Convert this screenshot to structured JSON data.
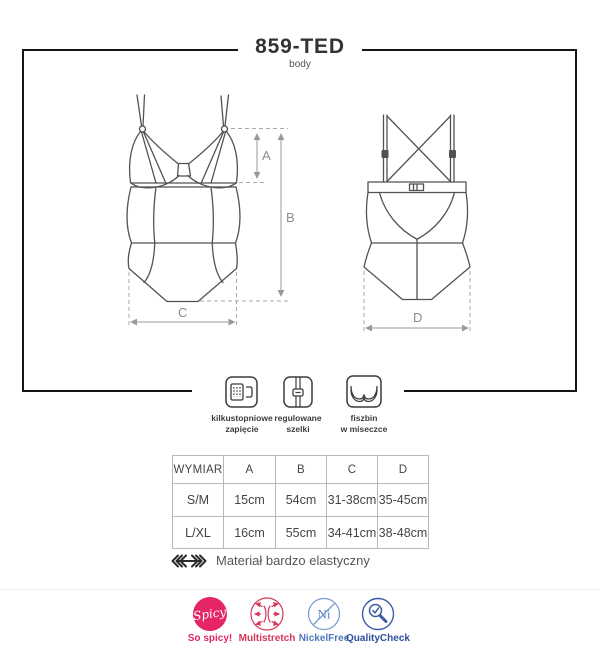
{
  "header": {
    "title": "859-TED",
    "subtitle": "body"
  },
  "diagram": {
    "labels": {
      "a": "A",
      "b": "B",
      "c": "C",
      "d": "D"
    }
  },
  "features": {
    "items": [
      {
        "icon": "hook-clasp-icon",
        "line1": "kilkustopniowe",
        "line2": "zapięcie"
      },
      {
        "icon": "strap-slider-icon",
        "line1": "regulowane",
        "line2": "szelki"
      },
      {
        "icon": "underwire-cup-icon",
        "line1": "fiszbin",
        "line2": "w miseczce"
      }
    ]
  },
  "size_table": {
    "headers": [
      "WYMIAR",
      "A",
      "B",
      "C",
      "D"
    ],
    "rows": [
      [
        "S/M",
        "15cm",
        "54cm",
        "31-38cm",
        "35-45cm"
      ],
      [
        "L/XL",
        "16cm",
        "55cm",
        "34-41cm",
        "38-48cm"
      ]
    ]
  },
  "material_note": {
    "icon": "stretch-arrow-icon",
    "text": "Materiał bardzo elastyczny"
  },
  "badges": {
    "items": [
      {
        "name": "spicy",
        "circle_text": "Spicy",
        "label": "So spicy!",
        "color": "#e62565"
      },
      {
        "name": "multistretch",
        "label": "Multistretch",
        "color": "#d6365a"
      },
      {
        "name": "nickel-free",
        "circle_text": "Ni",
        "label": "NickelFree",
        "color": "#4d79bd"
      },
      {
        "name": "quality-check",
        "label": "QualityCheck",
        "color": "#2f4f9e"
      }
    ]
  }
}
